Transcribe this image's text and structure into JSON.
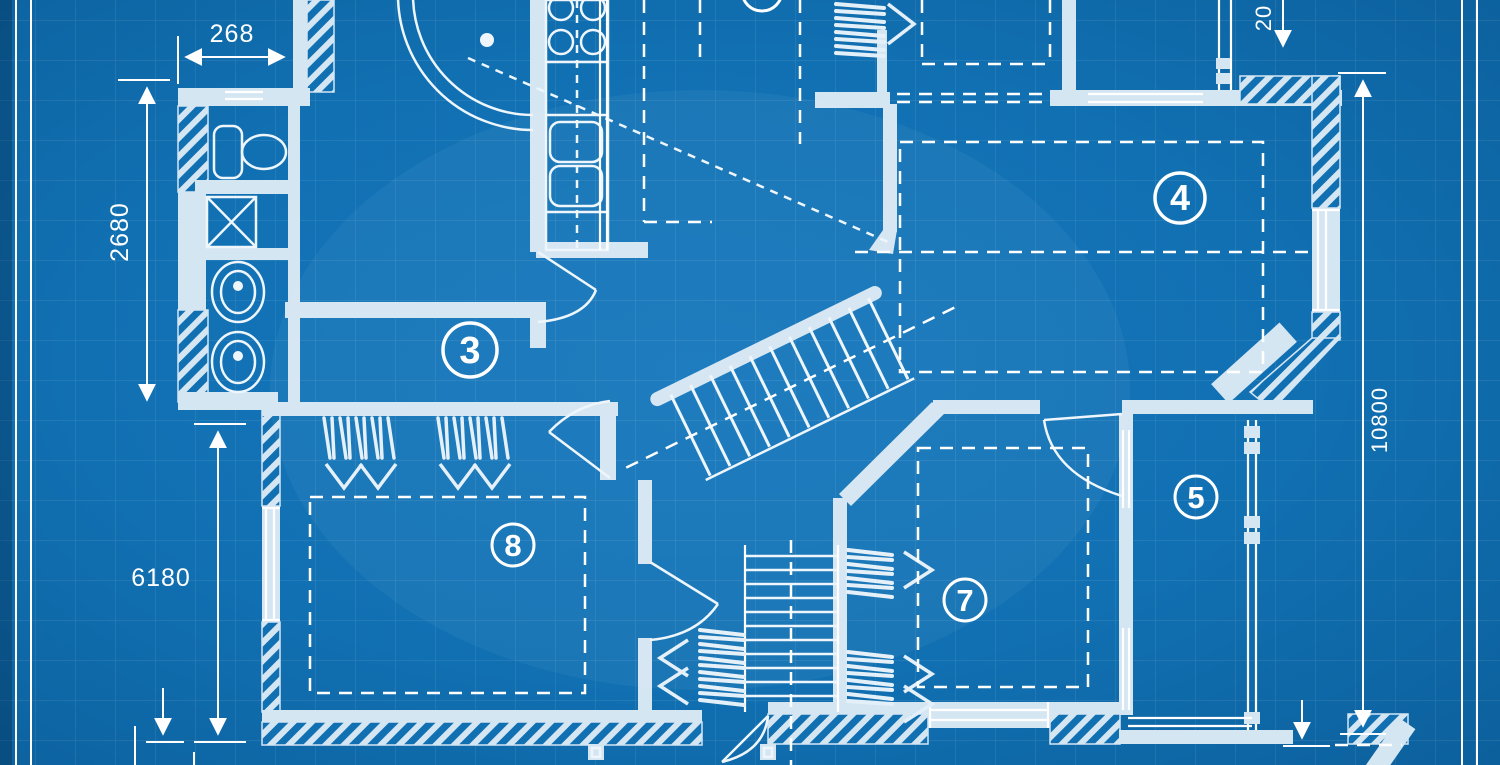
{
  "meta": {
    "description": "Blueprint floor plan, top-down architectural drawing"
  },
  "colors": {
    "background": "#1170b2",
    "background_edge": "#0c609c",
    "wall_fill": "#d5e6f3",
    "line": "#ffffff",
    "grid": "rgba(255,255,255,0.15)"
  },
  "rooms": [
    {
      "id": "room-3",
      "number": "3"
    },
    {
      "id": "room-4",
      "number": "4"
    },
    {
      "id": "room-5",
      "number": "5"
    },
    {
      "id": "room-7",
      "number": "7"
    },
    {
      "id": "room-8",
      "number": "8"
    }
  ],
  "dimensions": {
    "top_width": "268",
    "left_upper_height": "2680",
    "left_lower_height": "6180",
    "right_height": "10800",
    "top_right_partial": "20"
  }
}
